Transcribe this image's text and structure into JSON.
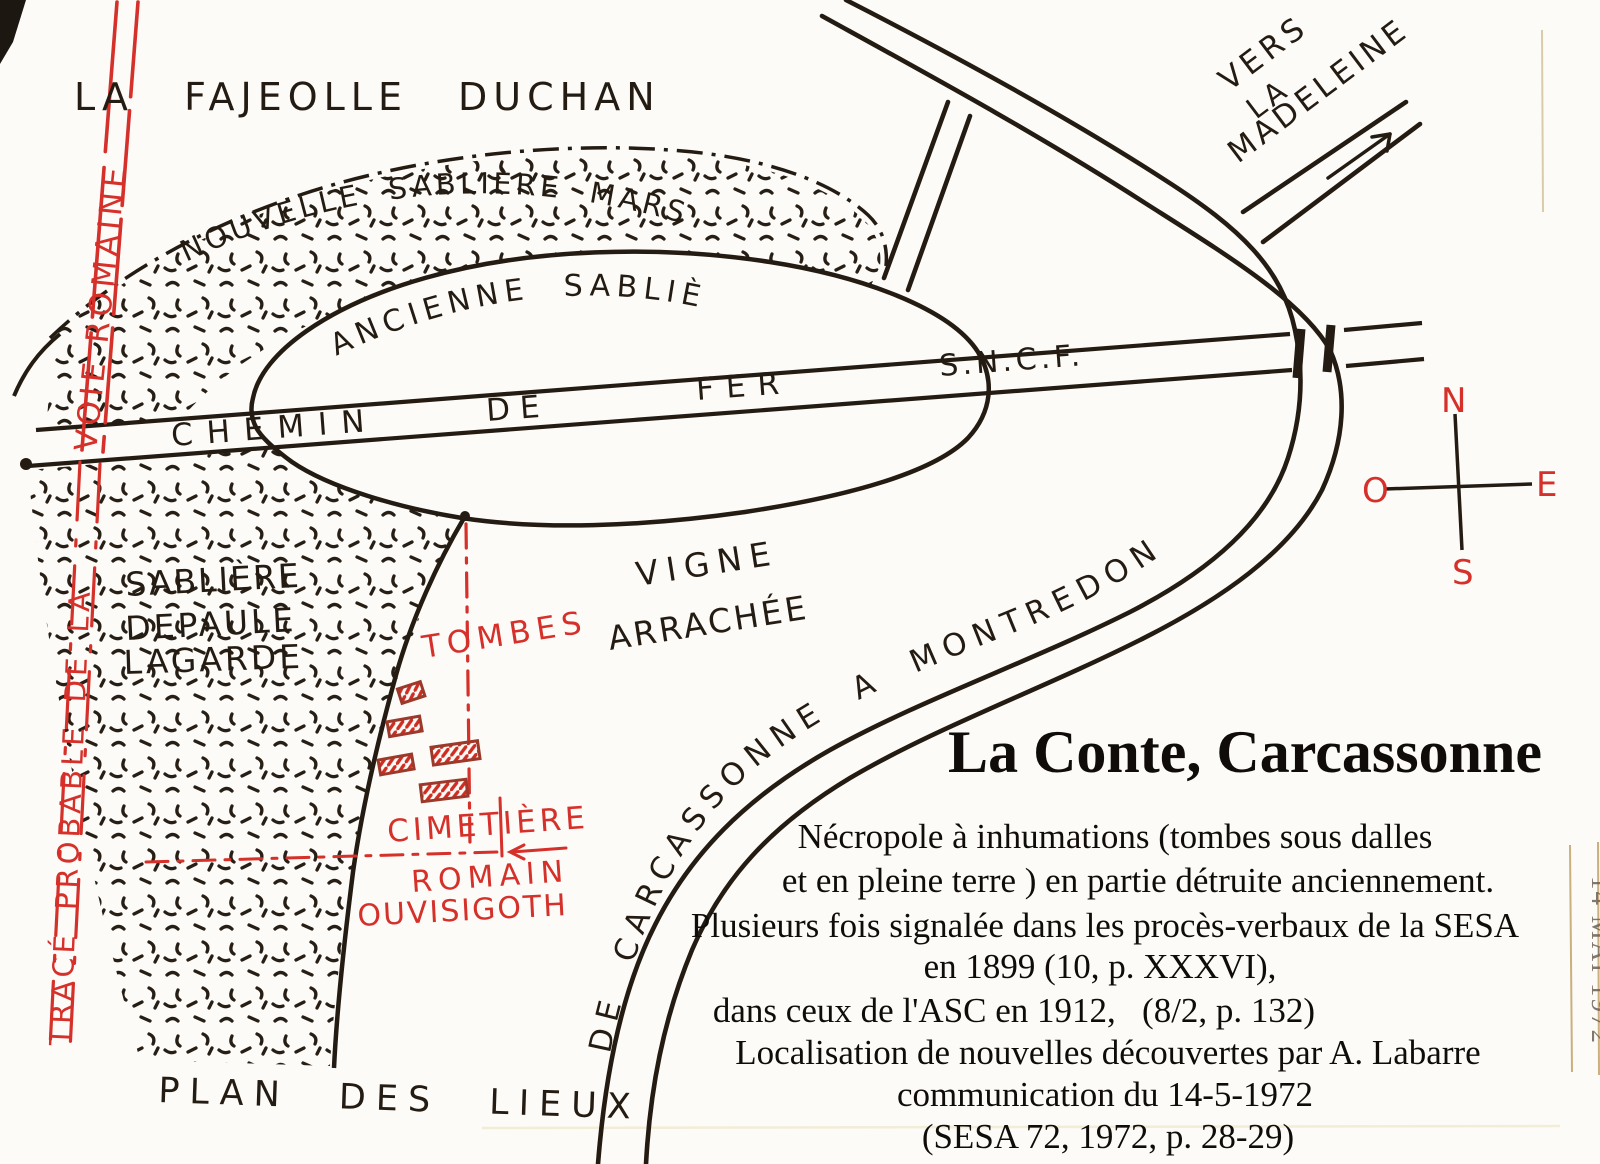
{
  "map": {
    "labels": {
      "la_fajeolle": "LA FAJEOLLE DUCHAN",
      "nouvelle_sabliere": "NOUVELLE SABLIÈRE MARSON",
      "ancienne_sabliere": "ANCIENNE SABLIÈRE",
      "railway_words": [
        "CHEMIN",
        "DE",
        "FER",
        "S.N.C.F."
      ],
      "vers_lines": [
        "VERS",
        "LA",
        "MADELEINE"
      ],
      "sabliere_lines": [
        "SABLIÈRE",
        "DEPAULE",
        "LAGARDE"
      ],
      "vigne_line1": "VIGNE",
      "vigne_line2": "ARRACHÉE",
      "road_montredon": "DE CARCASSONNE A MONTREDON",
      "plan_des_lieux": "PLAN DES LIEUX"
    },
    "red": {
      "voie_romaine": "VOIE ROMAINE",
      "trace_probable": "TRACÉ PROBABLE DE LA",
      "tombes": "TOMBES",
      "cimetiere": "CIMETIÈRE",
      "romain": "ROMAIN",
      "ouvisigoth": "OUVISIGOTH"
    },
    "compass": {
      "n": "N",
      "e": "E",
      "s": "S",
      "o": "O"
    }
  },
  "caption": {
    "title": "La Conte, Carcassonne",
    "lines": [
      "Nécropole à inhumations (tombes sous dalles",
      "et en pleine terre ) en partie détruite anciennement.",
      "Plusieurs fois signalée dans les procès-verbaux de la SESA",
      "en 1899 (10, p. XXXVI),",
      "dans ceux de l'ASC en 1912,   (8/2, p. 132)",
      "Localisation de nouvelles découvertes par A. Labarre",
      "communication du 14-5-1972",
      "(SESA 72, 1972, p. 28-29)"
    ]
  },
  "stamp": {
    "date": "14 MAI 1972"
  },
  "colors": {
    "ink": "#241c13",
    "red": "#d5302a",
    "paper": "#fcfbf7"
  }
}
